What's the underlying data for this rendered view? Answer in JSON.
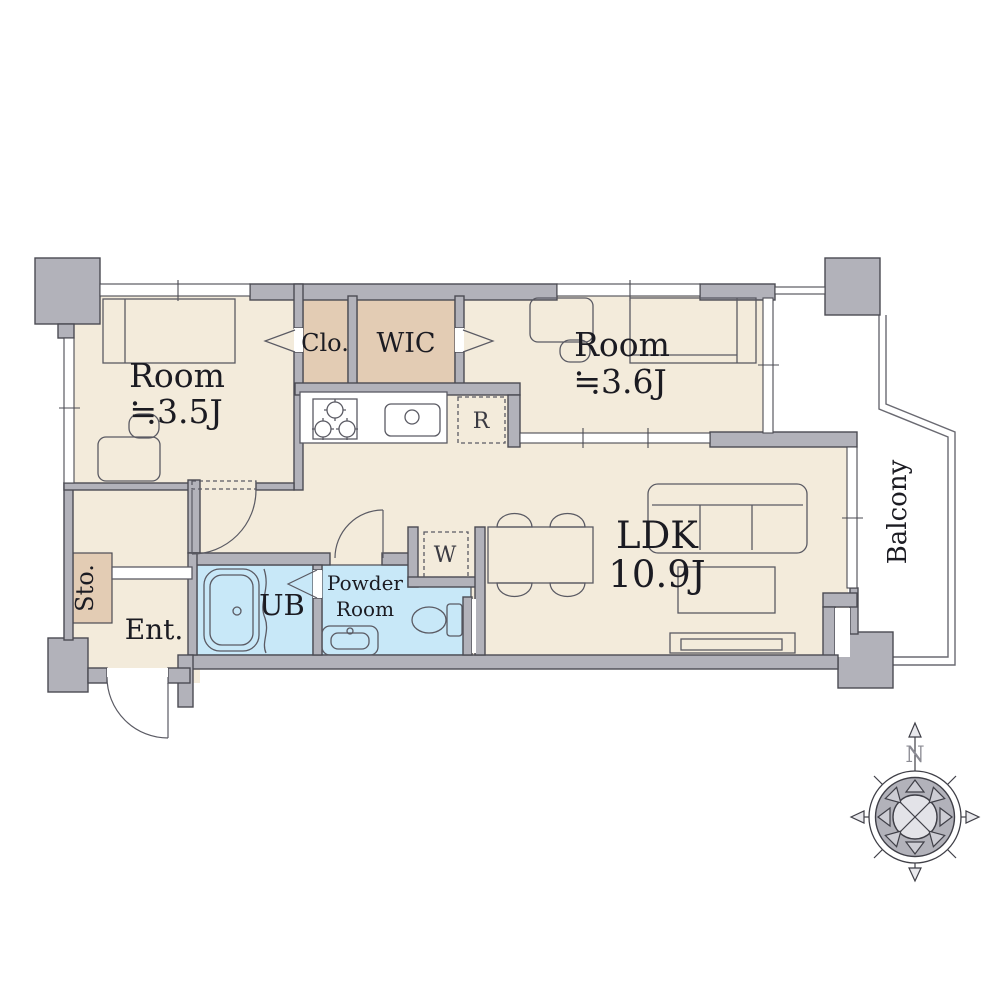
{
  "plan": {
    "rooms": {
      "room_a": {
        "label": "Room",
        "size": "≒3.5J"
      },
      "room_b": {
        "label": "Room",
        "size": "≒3.6J"
      },
      "ldk": {
        "label": "LDK",
        "size": "10.9J"
      },
      "closet": {
        "label": "Clo."
      },
      "wic": {
        "label": "WIC"
      },
      "unit_bath": {
        "label": "UB"
      },
      "powder_room": {
        "line1": "Powder",
        "line2": "Room"
      },
      "entrance": {
        "label": "Ent."
      },
      "storage": {
        "label": "Sto."
      },
      "balcony": {
        "label": "Balcony"
      }
    },
    "appliances": {
      "refrigerator": "R",
      "washer": "W"
    },
    "compass": {
      "north": "N"
    },
    "colors": {
      "floor": "#f3ebdb",
      "closet_fill": "#e3ccb4",
      "wet_fill": "#c8e8f8",
      "wall": "#b2b2ba",
      "line": "#4b4b53",
      "text": "#1b1b22"
    }
  }
}
